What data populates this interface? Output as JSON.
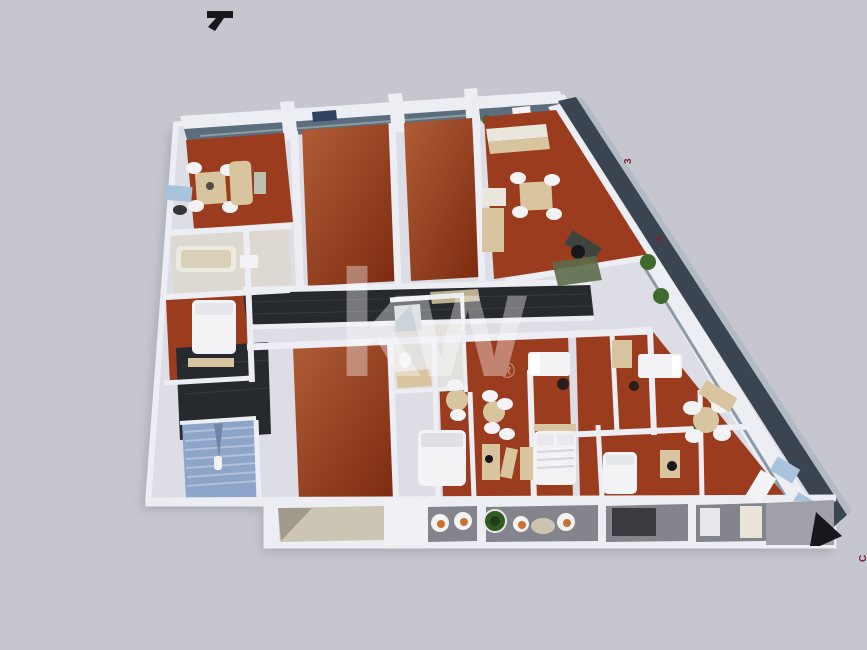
{
  "watermark": {
    "text": "kw",
    "registered": "®"
  },
  "markers": {
    "right_upper": "3",
    "right_middle": "A",
    "bottom_right": "C"
  },
  "colors": {
    "bg": "#c5c6ce",
    "wall": "#edeef4",
    "slab": "#dcdde5",
    "floor": "#9c3c1e",
    "floor_light": "#b05c36",
    "floor_dark": "#7c2a10",
    "dark_tile": "#26292d",
    "roof_band": "#3b4451",
    "roof_lip": "#b4bac4",
    "glass": "#5c6e7d",
    "stair_blue": "#8ca5c8",
    "stair_step": "#b9c8de",
    "balcony_gray": "#84858c",
    "balcony_beige": "#cdc5b4",
    "wood": "#d8c5a0",
    "white_furniture": "#f3f3f6",
    "plant_green": "#3e6b2d",
    "rug_green": "#5c6b4a",
    "accent_orange": "#c9722f",
    "furniture_blue": "#a9c3dd",
    "marker_red": "#7a2231",
    "ink": "#17181c",
    "watermark_white": "#ffffff"
  }
}
